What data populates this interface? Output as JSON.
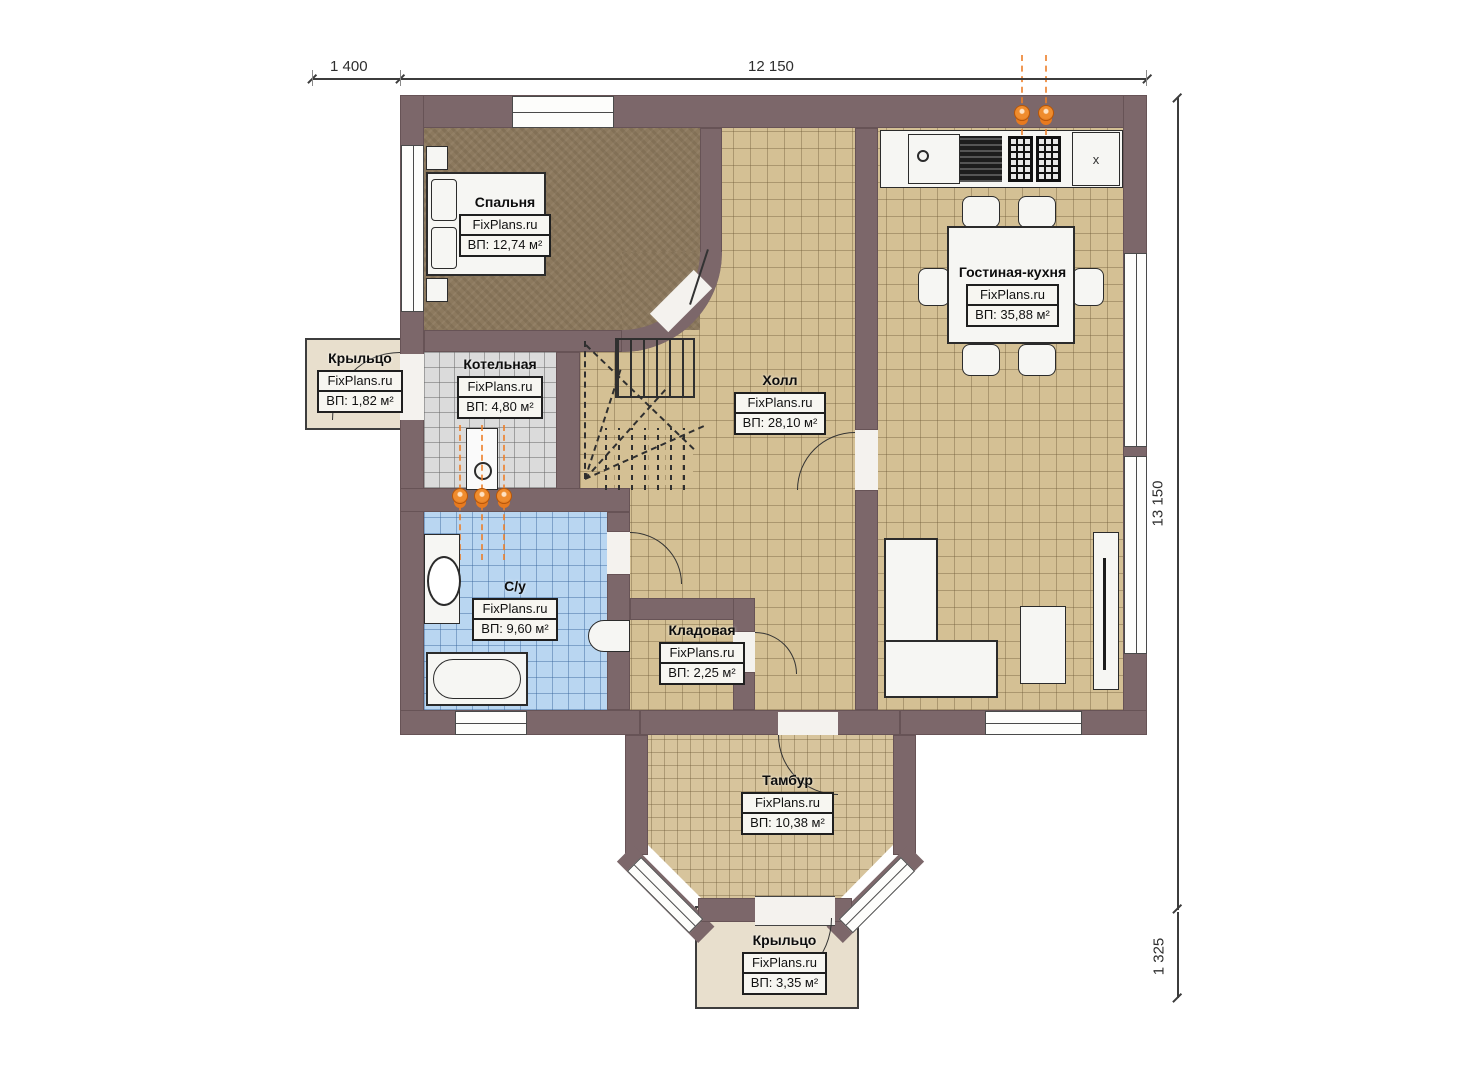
{
  "brand": "FixPlans.ru",
  "dimensions": {
    "top_left": "1 400",
    "top_main": "12 150",
    "right_main": "13 150",
    "right_bottom": "1 325"
  },
  "rooms": {
    "bedroom": {
      "name": "Спальня",
      "brand": "FixPlans.ru",
      "area": "ВП: 12,74 м²"
    },
    "porch_left": {
      "name": "Крыльцо",
      "brand": "FixPlans.ru",
      "area": "ВП: 1,82 м²"
    },
    "boiler_room": {
      "name": "Котельная",
      "brand": "FixPlans.ru",
      "area": "ВП: 4,80 м²"
    },
    "hall": {
      "name": "Холл",
      "brand": "FixPlans.ru",
      "area": "ВП: 28,10 м²"
    },
    "living_kitchen": {
      "name": "Гостиная-кухня",
      "brand": "FixPlans.ru",
      "area": "ВП: 35,88 м²"
    },
    "bathroom": {
      "name": "С/у",
      "brand": "FixPlans.ru",
      "area": "ВП: 9,60 м²"
    },
    "storage": {
      "name": "Кладовая",
      "brand": "FixPlans.ru",
      "area": "ВП: 2,25 м²"
    },
    "vestibule": {
      "name": "Тамбур",
      "brand": "FixPlans.ru",
      "area": "ВП: 10,38 м²"
    },
    "porch_bottom": {
      "name": "Крыльцо",
      "brand": "FixPlans.ru",
      "area": "ВП: 3,35 м²"
    }
  },
  "symbols": {
    "fridge": "x"
  },
  "colors": {
    "wall": "#7c676a",
    "floor_tile": "#d4c094",
    "floor_bedroom": "#8c795e",
    "floor_bathroom": "#b9d6f1",
    "floor_boiler": "#dbdbdb",
    "porch": "#e8dfcd",
    "gas_accent": "#e87a1e"
  }
}
